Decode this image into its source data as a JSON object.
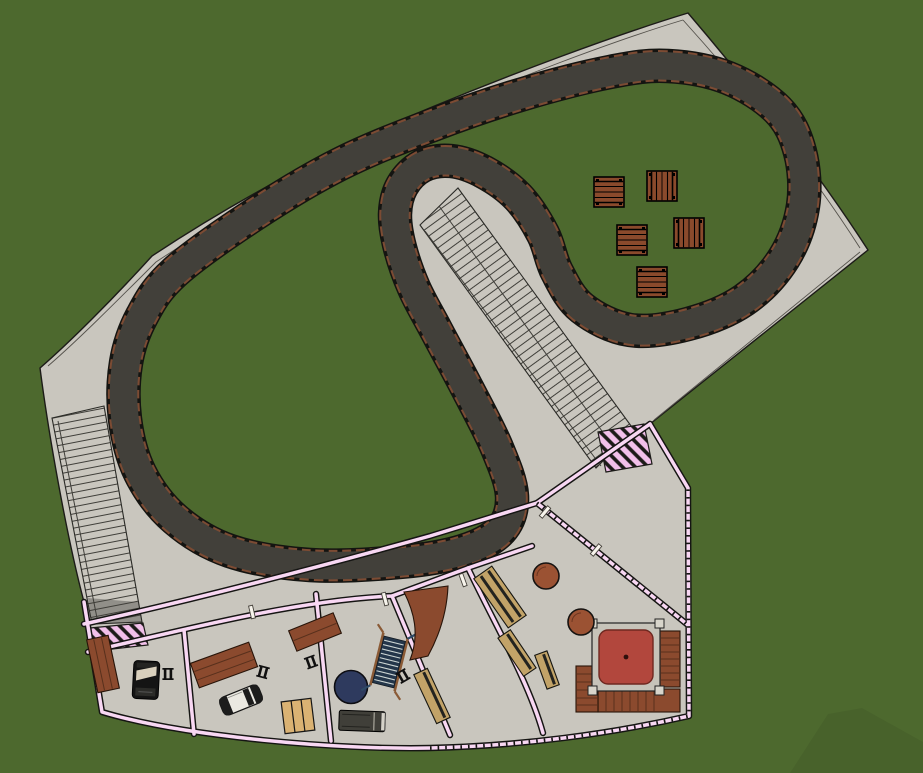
{
  "scene": {
    "kind": "site-plan",
    "subject": "karting-track-facility"
  },
  "colors": {
    "grass": "#4d692e",
    "pavement": "#c9c6be",
    "outline": "#1c1b18",
    "asphalt": "#42403a",
    "curb": "#7c4b33",
    "hatch": "#3f3e39",
    "wall": "#f8d7f3",
    "ramp": "#f2c0ea",
    "wood": "#8b4a2e",
    "woodline": "#58301c",
    "khaki": "#c2a368",
    "khakiline": "#23231f",
    "tan": "#dab273",
    "redpad": "#b2473d",
    "redpadline": "#6f2820",
    "frame": "#c6c3b9",
    "post": "#d8d5cb",
    "blue": "#2e3a5e",
    "stairdark": "#24364a",
    "stairlight": "#ccd5d3",
    "rail": "#8a5a36",
    "carwhite": "#eae8e1",
    "carblack": "#141414",
    "vangray": "#403f39",
    "bumper": "#d5d2c9",
    "door": "#f7f4ec",
    "tablewood": "#8a4a2c"
  },
  "objects": {
    "picnic_tables": [
      {
        "x": 594,
        "y": 177,
        "orient": "h"
      },
      {
        "x": 647,
        "y": 171,
        "orient": "v"
      },
      {
        "x": 617,
        "y": 225,
        "orient": "h"
      },
      {
        "x": 674,
        "y": 218,
        "orient": "v"
      },
      {
        "x": 637,
        "y": 267,
        "orient": "h"
      }
    ],
    "round_tables": [
      {
        "x": 546,
        "y": 576,
        "r": 13
      },
      {
        "x": 581,
        "y": 622,
        "r": 13
      }
    ],
    "bench_icons": [
      {
        "x": 168,
        "y": 674,
        "rot": 0
      },
      {
        "x": 263,
        "y": 672,
        "rot": 15
      },
      {
        "x": 311,
        "y": 662,
        "rot": -20
      },
      {
        "x": 403,
        "y": 676,
        "rot": -30
      }
    ],
    "khaki_benches": [
      {
        "x": 500,
        "y": 597,
        "rot": -35,
        "w": 22,
        "l": 60,
        "stripes": 2
      },
      {
        "x": 517,
        "y": 653,
        "rot": -34,
        "w": 15,
        "l": 46,
        "stripes": 1
      },
      {
        "x": 547,
        "y": 670,
        "rot": -20,
        "w": 13,
        "l": 36,
        "stripes": 1
      },
      {
        "x": 432,
        "y": 696,
        "rot": -25,
        "w": 15,
        "l": 54,
        "stripes": 1
      }
    ],
    "doors": [
      {
        "x": 252,
        "y": 612,
        "rot": -13
      },
      {
        "x": 385,
        "y": 599,
        "rot": -15
      },
      {
        "x": 463,
        "y": 580,
        "rot": -20
      },
      {
        "x": 545,
        "y": 512,
        "rot": 40
      },
      {
        "x": 596,
        "y": 550,
        "rot": 40
      }
    ],
    "vehicles": [
      "black-van",
      "white-sports-car",
      "gray-van"
    ],
    "features": [
      "race-track",
      "left-grandstand-strip",
      "central-grandstand-strip",
      "pink-ramp-left",
      "pink-ramp-right",
      "staircase",
      "blue-circle-pad",
      "red-platform-with-deck",
      "picnic-area",
      "garage-bays"
    ]
  }
}
